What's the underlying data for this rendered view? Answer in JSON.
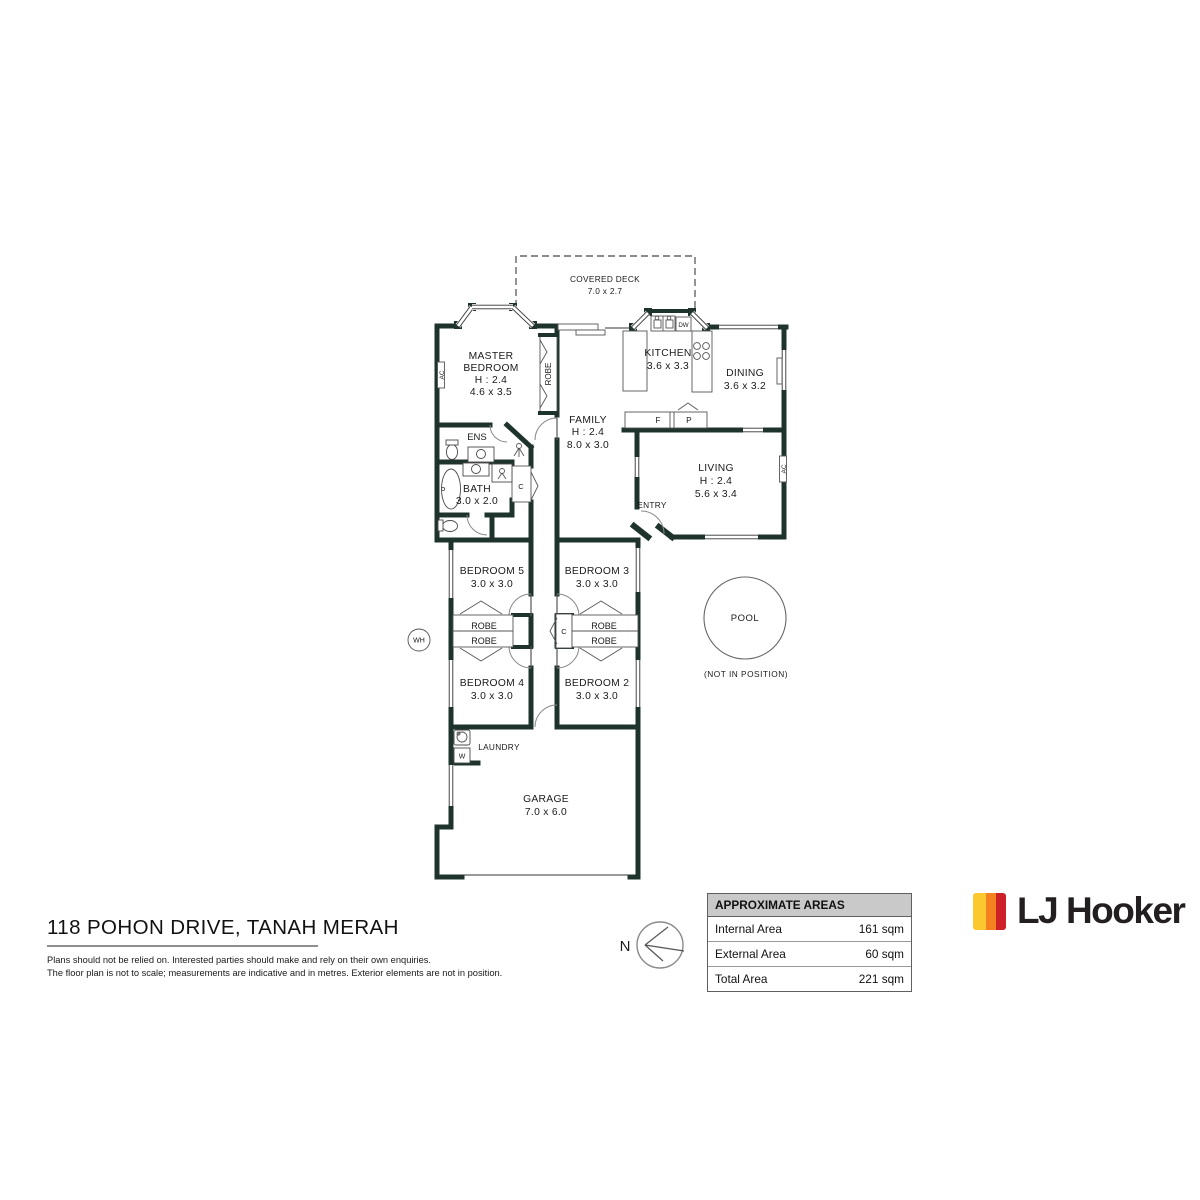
{
  "rooms": {
    "deck": {
      "name": "COVERED DECK",
      "dims": "7.0 x 2.7"
    },
    "master": {
      "name1": "MASTER",
      "name2": "BEDROOM",
      "height": "H : 2.4",
      "dims": "4.6 x 3.5"
    },
    "kitchen": {
      "name": "KITCHEN",
      "dims": "3.6 x 3.3"
    },
    "dining": {
      "name": "DINING",
      "dims": "3.6 x 3.2"
    },
    "family": {
      "name": "FAMILY",
      "height": "H : 2.4",
      "dims": "8.0 x 3.0"
    },
    "living": {
      "name": "LIVING",
      "height": "H : 2.4",
      "dims": "5.6 x 3.4"
    },
    "ens": {
      "name": "ENS"
    },
    "bath": {
      "name": "BATH",
      "dims": "3.0 x 2.0"
    },
    "entry": {
      "name": "ENTRY"
    },
    "bedroom5": {
      "name": "BEDROOM 5",
      "dims": "3.0 x 3.0"
    },
    "bedroom3": {
      "name": "BEDROOM 3",
      "dims": "3.0 x 3.0"
    },
    "bedroom4": {
      "name": "BEDROOM 4",
      "dims": "3.0 x 3.0"
    },
    "bedroom2": {
      "name": "BEDROOM 2",
      "dims": "3.0 x 3.0"
    },
    "laundry": {
      "name": "LAUNDRY"
    },
    "garage": {
      "name": "GARAGE",
      "dims": "7.0 x 6.0"
    },
    "pool": {
      "name": "POOL",
      "note": "(NOT IN POSITION)"
    }
  },
  "labels": {
    "robe": "ROBE",
    "closet": "C",
    "fridge": "F",
    "pantry": "P",
    "dishwasher": "DW",
    "washer": "W",
    "water_heater": "WH",
    "ac": "AC",
    "north": "N"
  },
  "footer": {
    "address": "118 POHON DRIVE, TANAH MERAH",
    "disclaimer1": "Plans should not be relied on. Interested parties should make and rely on their own enquiries.",
    "disclaimer2": "The floor plan is not to scale; measurements are indicative and in metres. Exterior elements are not in position."
  },
  "areas_table": {
    "header": "APPROXIMATE AREAS",
    "rows": [
      {
        "label": "Internal Area",
        "value": "161 sqm"
      },
      {
        "label": "External Area",
        "value": "60 sqm"
      },
      {
        "label": "Total Area",
        "value": "221 sqm"
      }
    ]
  },
  "logo": {
    "brand": "LJ Hooker",
    "stripe_colors": [
      "#FDC82F",
      "#F58220",
      "#CE2027"
    ],
    "text_color": "#231f20"
  },
  "plan_colors": {
    "wall": "#1f332d"
  }
}
